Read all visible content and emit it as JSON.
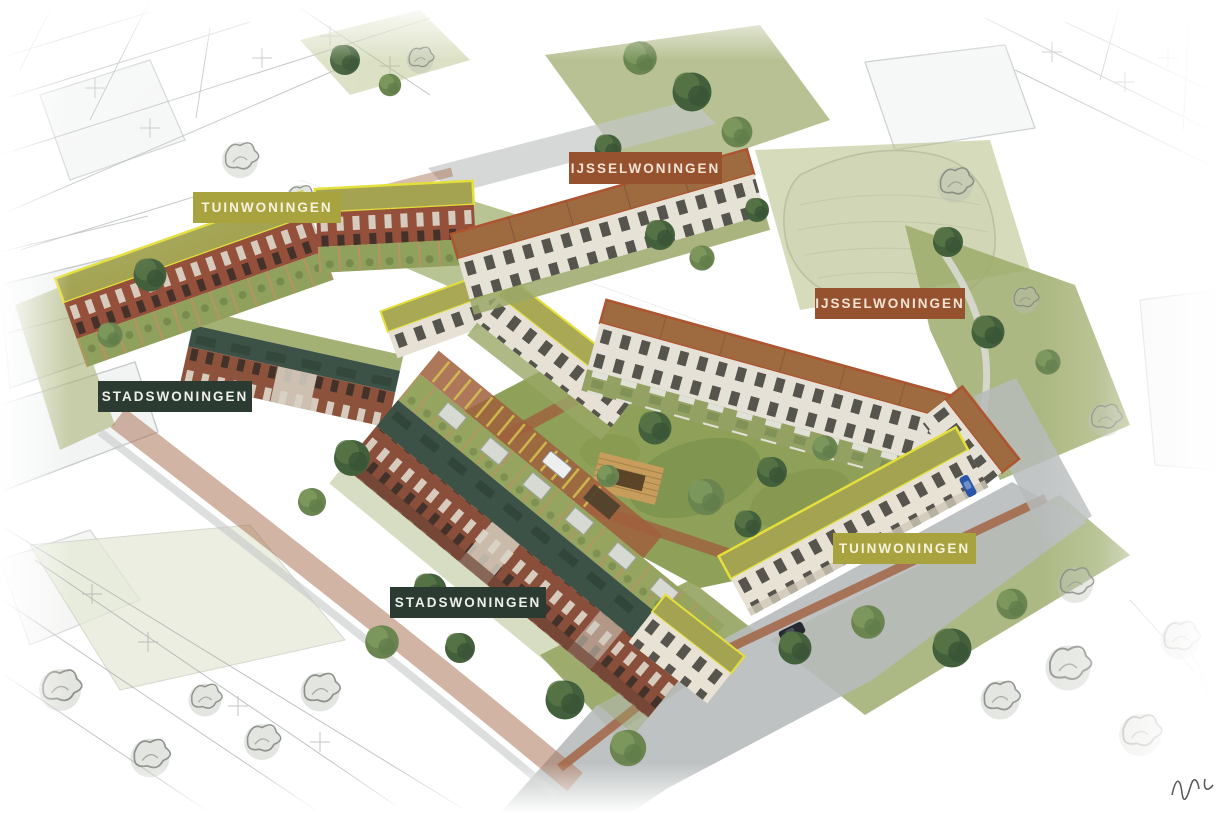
{
  "labels": [
    {
      "text": "TUINWONINGEN",
      "type": "tuinwoningen",
      "color": "#a8a33e",
      "text_color": "#f6f2de"
    },
    {
      "text": "IJSSELWONINGEN",
      "type": "ijsselwoningen",
      "color": "#96512f",
      "text_color": "#f2e3d3"
    },
    {
      "text": "IJSSELWONINGEN",
      "type": "ijsselwoningen",
      "color": "#96512f",
      "text_color": "#f2e3d3"
    },
    {
      "text": "STADSWONINGEN",
      "type": "stadswoningen",
      "color": "#2c3b32",
      "text_color": "#eef0ea"
    },
    {
      "text": "STADSWONINGEN",
      "type": "stadswoningen",
      "color": "#2c3b32",
      "text_color": "#eef0ea"
    },
    {
      "text": "TUINWONINGEN",
      "type": "tuinwoningen",
      "color": "#a8a33e",
      "text_color": "#f6f2de"
    }
  ],
  "housing_types": [
    {
      "name": "TUINWONINGEN",
      "badge_color": "#a8a33e",
      "outline_color": "#e4df3b",
      "roof_color": "#a3a352"
    },
    {
      "name": "IJSSELWONINGEN",
      "badge_color": "#96512f",
      "outline_color": "#ad5430",
      "roof_color": "#9e6a40"
    },
    {
      "name": "STADSWONINGEN",
      "badge_color": "#2c3b32",
      "outline_color": "#3d5246",
      "roof_color": "#3d5246"
    }
  ],
  "palette": {
    "lawn": "#8fa058",
    "brick_facade": "#8d523c",
    "cream_facade": "#e7e2d6",
    "brick_paving": "#9f5f3d",
    "road": "#b7bbbb",
    "tuin_roof": "#a3a352",
    "tuin_outline": "#e4df3b",
    "ijssel_roof": "#9e6a40",
    "ijssel_outline": "#ad5430",
    "stads_roof": "#3d5246"
  }
}
